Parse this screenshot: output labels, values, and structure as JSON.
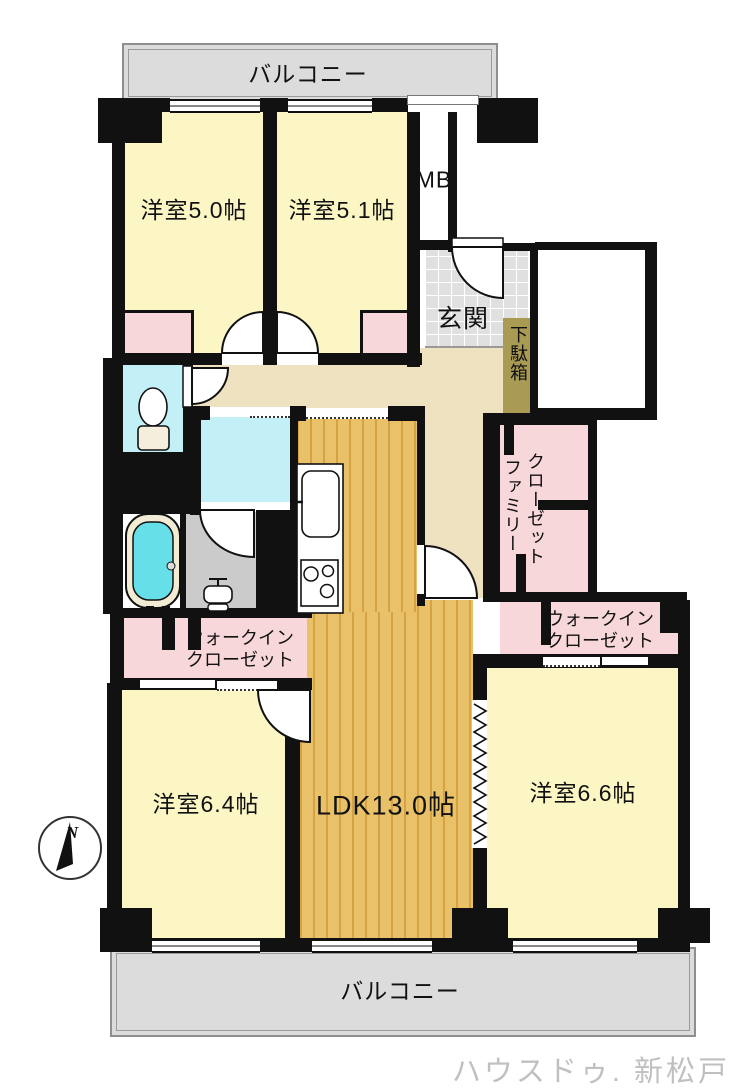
{
  "balcony": {
    "top": "バルコニー",
    "bottom": "バルコニー"
  },
  "rooms": {
    "bedroom_5_0": "洋室5.0帖",
    "bedroom_5_1": "洋室5.1帖",
    "meter_box": "MB",
    "entrance": "玄関",
    "shoe_cabinet": "下駄箱",
    "family_closet": {
      "line1": "ファミリー",
      "line2": "クローゼット"
    },
    "walk_in_closet_left": {
      "line1": "ウォークイン",
      "line2": "クローゼット"
    },
    "walk_in_closet_right": {
      "line1": "ウォークイン",
      "line2": "クローゼット"
    },
    "bedroom_6_4": "洋室6.4帖",
    "ldk": "LDK13.0帖",
    "bedroom_6_6": "洋室6.6帖"
  },
  "compass": {
    "north_label": "N"
  },
  "watermark": "ハウスドゥ. 新松戸",
  "colors": {
    "room_yellow": "#fbf6c3",
    "closet_pink": "#f8d7db",
    "water_cyan": "#c2f0f6",
    "wood_floor": "#e8c169",
    "hallway_beige": "#efe2c0",
    "entrance_tile_gray": "#e0e0e0",
    "shoe_cabinet_khaki": "#a99a54",
    "balcony_gray": "#dcdcdc",
    "wall_black": "#111111",
    "watermark_gray": "#c0c0c0"
  }
}
